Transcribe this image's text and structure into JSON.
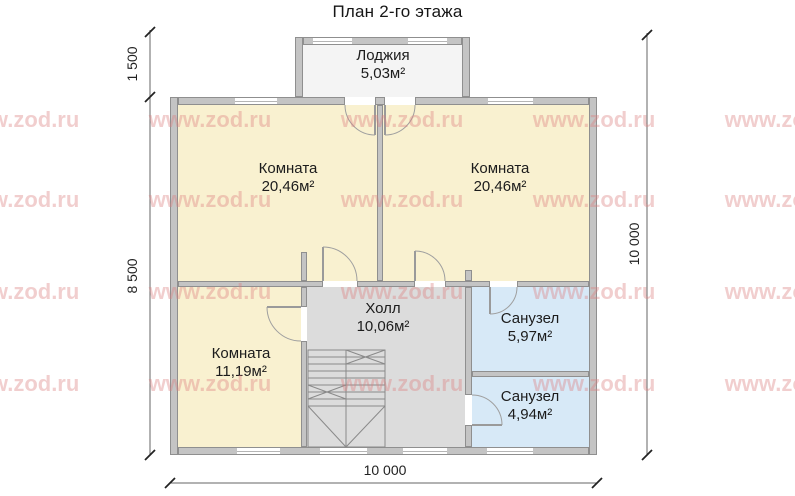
{
  "title": "План 2-го этажа",
  "watermark": {
    "text": "www.zod.ru"
  },
  "rooms": {
    "loggia": {
      "name": "Лоджия",
      "area": "5,03м²"
    },
    "room_tl": {
      "name": "Комната",
      "area": "20,46м²"
    },
    "room_tr": {
      "name": "Комната",
      "area": "20,46м²"
    },
    "room_bl": {
      "name": "Комната",
      "area": "11,19м²"
    },
    "hall": {
      "name": "Холл",
      "area": "10,06м²"
    },
    "bath1": {
      "name": "Санузел",
      "area": "5,97м²"
    },
    "bath2": {
      "name": "Санузел",
      "area": "4,94м²"
    }
  },
  "dimensions": {
    "left_top": "1 500",
    "left_main": "8 500",
    "right": "10 000",
    "bottom": "10 000"
  },
  "colors": {
    "room": "#f9f1d0",
    "hall": "#dcdcdc",
    "bath": "#d7e9f7",
    "loggia": "#f4f4f4",
    "wall": "#c4c4c4",
    "watermark": "#dd8080"
  }
}
